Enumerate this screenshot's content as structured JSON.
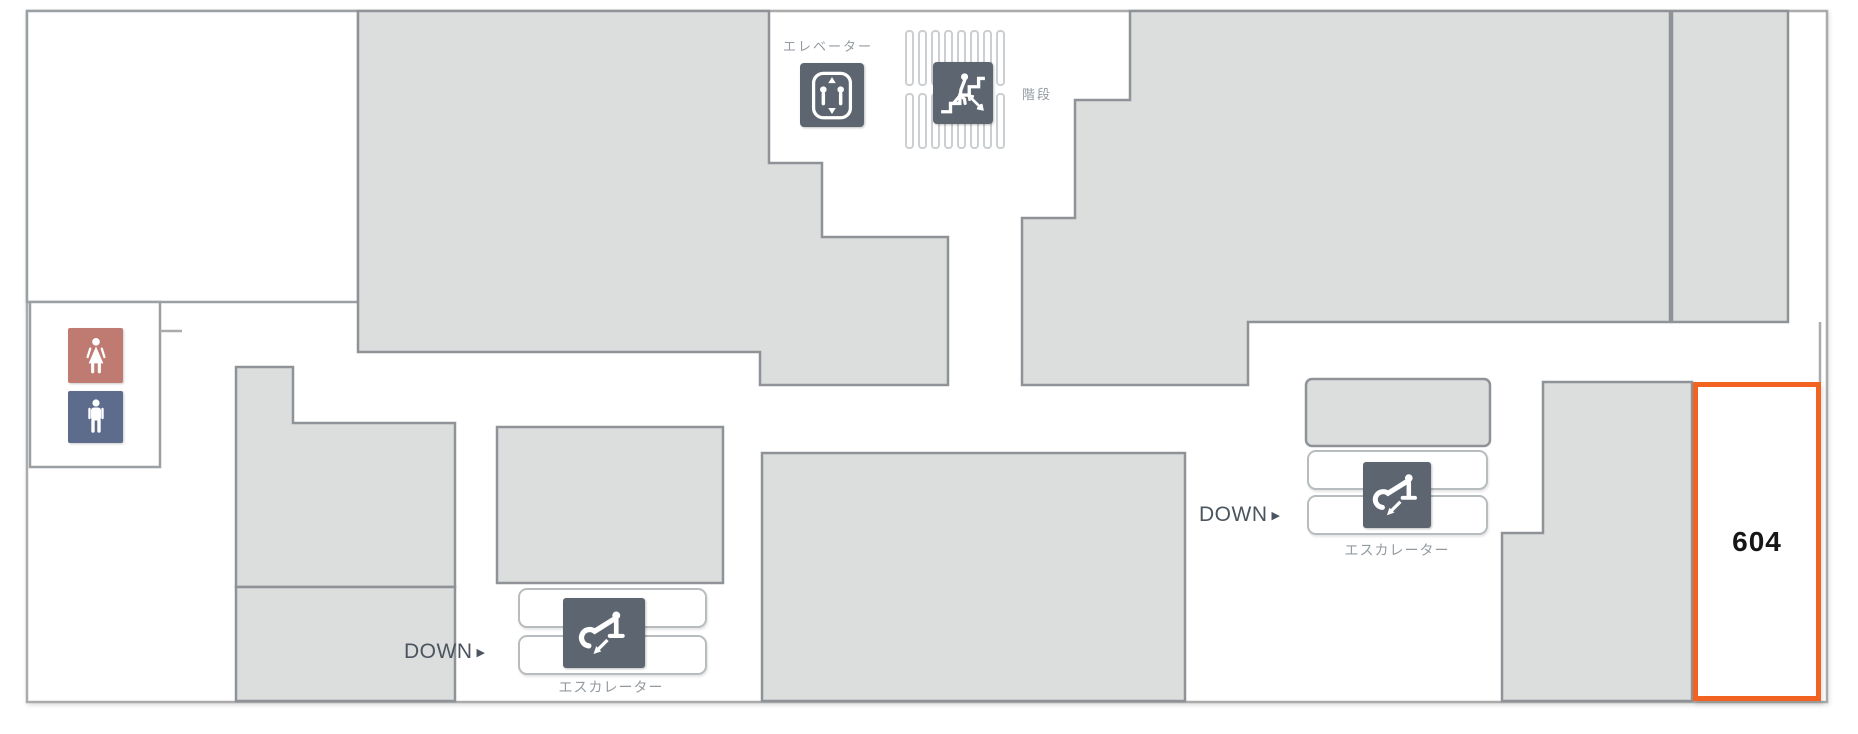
{
  "floor_map": {
    "elevator": {
      "label": "エレベーター"
    },
    "stairs": {
      "label": "階段"
    },
    "escalators": [
      {
        "id": "left",
        "direction_label": "DOWN",
        "arrow": "▶",
        "label": "エスカレーター"
      },
      {
        "id": "right",
        "direction_label": "DOWN",
        "arrow": "▶",
        "label": "エスカレーター"
      }
    ],
    "highlighted_room": {
      "number": "604"
    },
    "icons": [
      "women-restroom-icon",
      "men-restroom-icon",
      "elevator-icon",
      "stairs-icon",
      "escalator-icon"
    ]
  },
  "colors": {
    "accent_orange": "#f26322",
    "women_icon_bg": "#bf7b72",
    "men_icon_bg": "#5d6b8d",
    "sign_icon_bg": "#5d6670",
    "block_fill": "#dcdddd",
    "block_border": "#8f9296",
    "label_gray": "#939aa0",
    "down_text": "#4b555f"
  }
}
